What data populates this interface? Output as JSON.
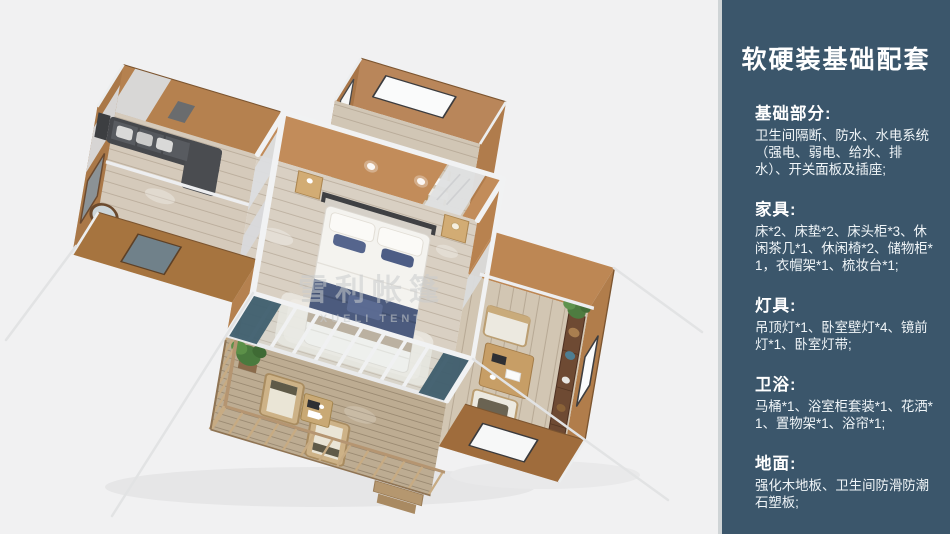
{
  "sidebar": {
    "background_color": "#3b566b",
    "divider_color": "#cfd4d6",
    "title": "软硬装基础配套",
    "sections": [
      {
        "heading": "基础部分:",
        "body": "卫生间隔断、防水、水电系统（强电、弱电、给水、排水）、开关面板及插座;"
      },
      {
        "heading": "家具:",
        "body": "床*2、床垫*2、床头柜*3、休闲茶几*1、休闲椅*2、储物柜*1，衣帽架*1、梳妆台*1;"
      },
      {
        "heading": "灯具:",
        "body": "吊顶灯*1、卧室壁灯*4、镜前灯*1、卧室灯带;"
      },
      {
        "heading": "卫浴:",
        "body": "马桶*1、浴室柜套装*1、花洒*1、置物架*1、浴帘*1;"
      },
      {
        "heading": "地面:",
        "body": "强化木地板、卫生间防滑防潮石塑板;"
      }
    ]
  },
  "render": {
    "background_color": "#f1f1f2",
    "watermark": "雪利帐篷",
    "watermark_latin": "XUELI TENT"
  }
}
